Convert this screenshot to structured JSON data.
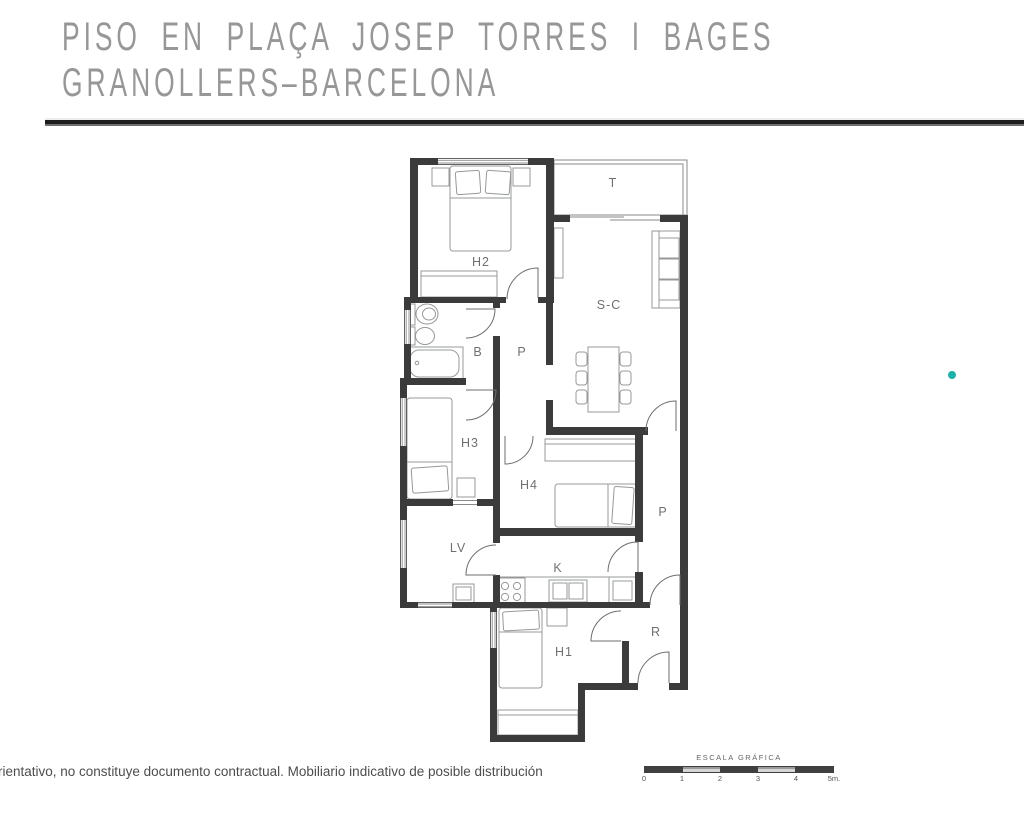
{
  "header": {
    "title_line1": "PISO EN PLAÇA JOSEP TORRES I BAGES",
    "title_line2": "GRANOLLERS–BARCELONA"
  },
  "floorplan": {
    "rooms": {
      "h2": "H2",
      "terrace": "T",
      "living_dining": "S-C",
      "bathroom": "B",
      "hallway": "P",
      "h3": "H3",
      "h4": "H4",
      "patio": "P",
      "laundry": "LV",
      "kitchen": "K",
      "h1": "H1",
      "entry_hall": "R"
    },
    "colors": {
      "wall": "#3b3b3c",
      "furniture_stroke": "#97989a",
      "thin_line": "#8a8a8a",
      "door_stroke": "#6e6e6e",
      "label": "#6f7072"
    },
    "marker_color": "#1cb2a9"
  },
  "footer": {
    "disclaimer": "rientativo, no constituye documento contractual. Mobiliario indicativo de posible distribución"
  },
  "scale": {
    "label": "ESCALA GRÁFICA",
    "ticks": [
      "0",
      "1",
      "2",
      "3",
      "4",
      "5m."
    ]
  }
}
